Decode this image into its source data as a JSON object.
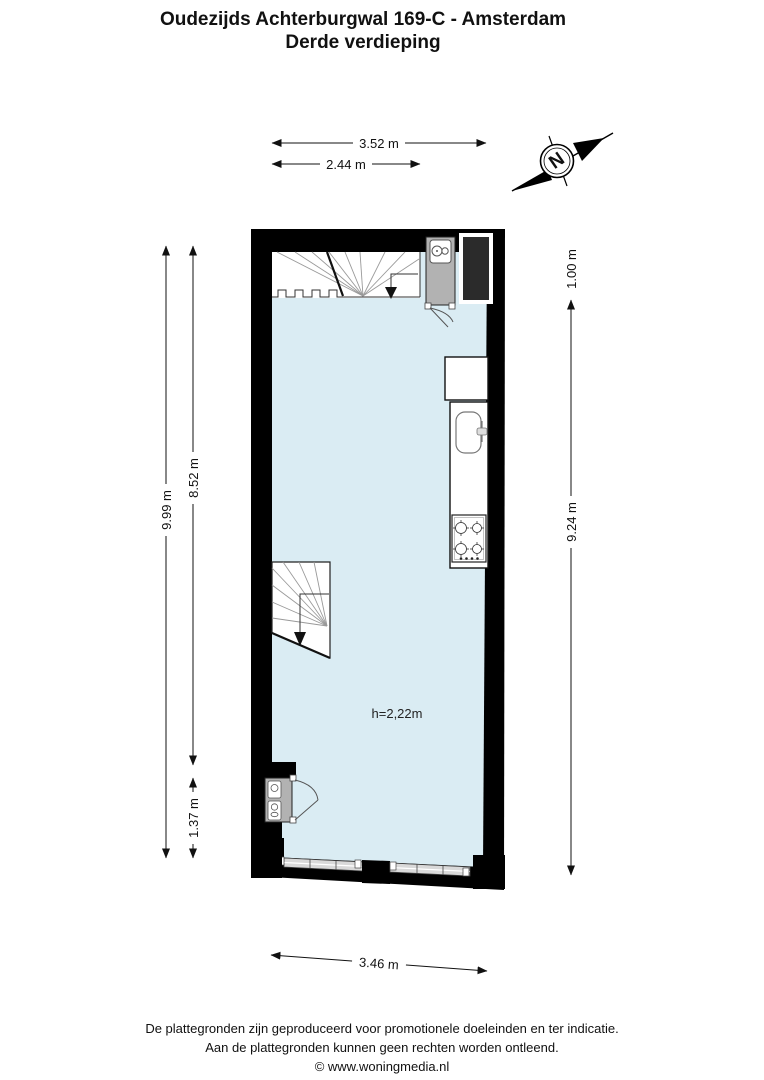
{
  "title": {
    "line1": "Oudezijds Achterburgwal 169-C - Amsterdam",
    "line2": "Derde verdieping"
  },
  "compass": {
    "north_letter": "N"
  },
  "dimensions": {
    "top_outer": "3.52 m",
    "top_inner": "2.44 m",
    "left_outer": "9.99 m",
    "left_inner_upper": "8.52 m",
    "left_inner_lower": "1.37 m",
    "right_upper": "1.00 m",
    "right_main": "9.24 m",
    "bottom": "3.46 m"
  },
  "room": {
    "ceiling_height": "h=2,22m"
  },
  "footer": {
    "line1": "De plattegronden zijn geproduceerd voor promotionele doeleinden en ter indicatie.",
    "line2": "Aan de plattegronden kunnen geen rechten worden ontleend.",
    "line3": "© www.woningmedia.nl"
  },
  "colors": {
    "wall": "#000000",
    "floor": "#daecf3",
    "cabinet": "#b2b2b2",
    "shaft": "#2b2b2b",
    "window_glass": "#d9d9d9"
  }
}
